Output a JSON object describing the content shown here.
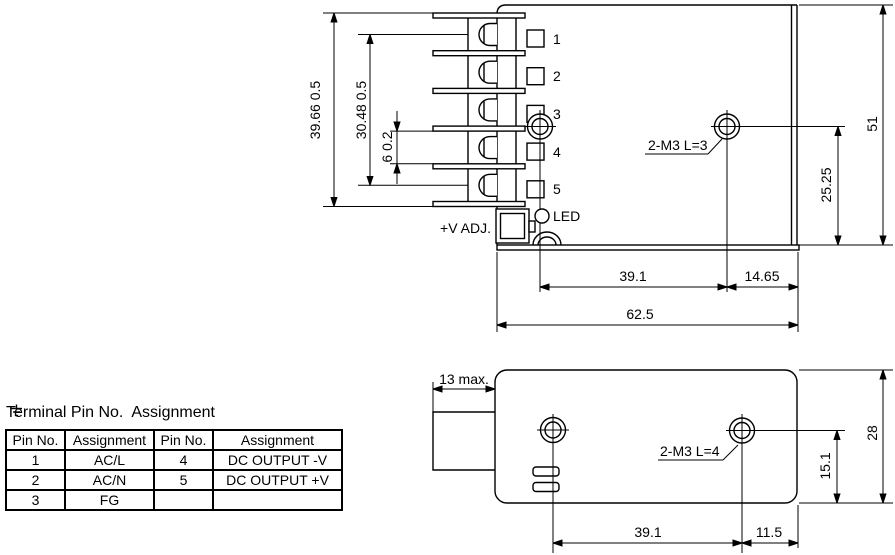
{
  "colors": {
    "ink": "#000000",
    "background": "#ffffff"
  },
  "top_view": {
    "pin_labels": [
      "1",
      "2",
      "3",
      "4",
      "5"
    ],
    "led_label": "LED",
    "vadj_label": "+V ADJ.",
    "screw_note": "2-M3 L=3",
    "dim_terminal_height": "39.66 0.5",
    "dim_terminal_pitch_span": "30.48 0.5",
    "dim_terminal_slot": "6 0.2",
    "dim_case_height": "51",
    "dim_hole_to_base": "25.25",
    "dim_hole_span": "39.1",
    "dim_hole_to_edge": "14.65",
    "dim_case_length": "62.5"
  },
  "bottom_view": {
    "screw_note": "2-M3 L=4",
    "dim_tab": "13 max.",
    "dim_case_width": "28",
    "dim_hole_to_side": "15.1",
    "dim_hole_span": "39.1",
    "dim_hole_to_edge": "11.5"
  },
  "pin_table": {
    "title": "Terminal Pin No.  Assignment",
    "headers": [
      "Pin No.",
      "Assignment",
      "Pin No.",
      "Assignment"
    ],
    "rows": [
      [
        "1",
        "AC/L",
        "4",
        "DC OUTPUT -V"
      ],
      [
        "2",
        "AC/N",
        "5",
        "DC OUTPUT +V"
      ],
      [
        "3",
        "FG",
        "",
        ""
      ]
    ]
  }
}
